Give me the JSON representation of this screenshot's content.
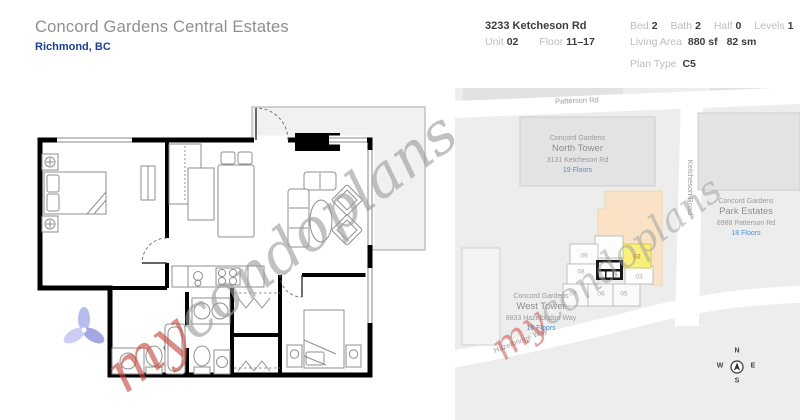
{
  "header": {
    "title": "Concord Gardens Central Estates",
    "location": "Richmond, BC"
  },
  "info": {
    "address": "3233 Ketcheson Rd",
    "unit_label": "Unit",
    "unit": "02",
    "floor_label": "Floor",
    "floor": "11–17",
    "bed_label": "Bed",
    "bed": "2",
    "bath_label": "Bath",
    "bath": "2",
    "half_label": "Half",
    "half": "0",
    "levels_label": "Levels",
    "levels": "1",
    "living_area_label": "Living Area",
    "living_area_sf": "880 sf",
    "living_area_sm": "82 sm",
    "plan_type_label": "Plan Type",
    "plan_type": "C5"
  },
  "watermark": {
    "prefix": "my",
    "suffix": "condoplans"
  },
  "map": {
    "roads": {
      "patterson": "Patterson Rd",
      "ketcheson": "Ketcheson Road",
      "hazelbridge": "Hazelbridge Way"
    },
    "north_tower": {
      "brand": "Concord Gardens",
      "name": "North Tower",
      "address": "3131 Ketcheson Rd",
      "floors": "19 Floors"
    },
    "park_estates": {
      "brand": "Concord Gardens",
      "name": "Park Estates",
      "address": "8988 Patterson Rd",
      "floors": "18 Floors"
    },
    "west_tower": {
      "brand": "Concord Gardens",
      "name": "West Tower",
      "address": "8833 Hazelbridge Way",
      "floors": "16 Floors"
    },
    "units": [
      {
        "n": "09"
      },
      {
        "n": "08"
      },
      {
        "n": "07"
      },
      {
        "n": "06"
      },
      {
        "n": "05"
      },
      {
        "n": "03"
      }
    ],
    "highlighted_unit": "02",
    "compass": {
      "n": "N",
      "e": "E",
      "s": "S",
      "w": "W"
    }
  },
  "colors": {
    "accent_blue": "#4a90d2",
    "highlight_yellow": "#f8f07a",
    "footprint_peach": "#f9e2c6",
    "watermark_red": "#c4473f",
    "location_navy": "#1d3f94"
  }
}
